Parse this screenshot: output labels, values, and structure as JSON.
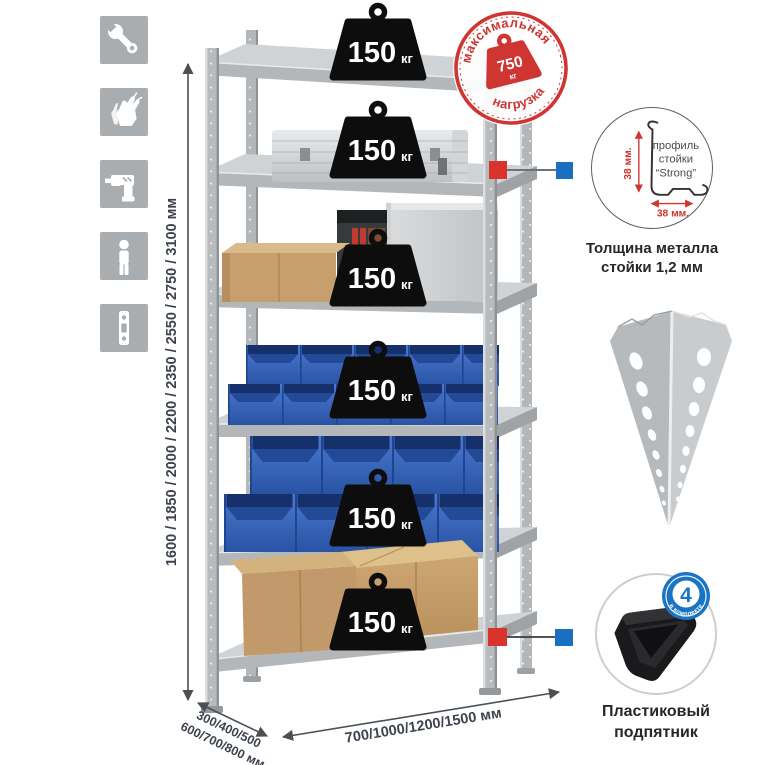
{
  "side_icons": [
    {
      "icon": "wrench-icon"
    },
    {
      "icon": "gloves-icon"
    },
    {
      "icon": "drill-icon"
    },
    {
      "icon": "person-icon"
    },
    {
      "icon": "rack-post-icon"
    }
  ],
  "max_load_badge": {
    "arc_top": "максимальная",
    "arc_bottom": "нагрузка",
    "value": "750",
    "unit": "кг"
  },
  "shelf_load": {
    "value": "150",
    "unit": "кг"
  },
  "dimensions": {
    "height_label": "1600 / 1850 / 2000 / 2200 / 2350 / 2550 / 2750 / 3100 мм",
    "depth_line1": "300/400/500",
    "depth_line2": "600/700/800 мм",
    "width_label": "700/1000/1200/1500 мм"
  },
  "profile_detail": {
    "label_line1": "профиль",
    "label_line2": "стойки",
    "label_line3": "“Strong”",
    "dim_vertical": "38 мм.",
    "dim_horizontal": "38 мм.",
    "caption_line1": "Толщина металла",
    "caption_line2": "стойки 1,2 мм"
  },
  "foot_detail": {
    "badge_value": "4",
    "badge_arc": "в комплекте",
    "caption_line1": "Пластиковый",
    "caption_line2": "подпятник"
  },
  "colors": {
    "accent_red": "#cf3531",
    "accent_blue": "#1b6fc0",
    "bin_blue": "#3566bf",
    "icon_gray": "#aaadb0",
    "metal_gray": "#c6c9cb",
    "dim_text": "#3d434d"
  }
}
